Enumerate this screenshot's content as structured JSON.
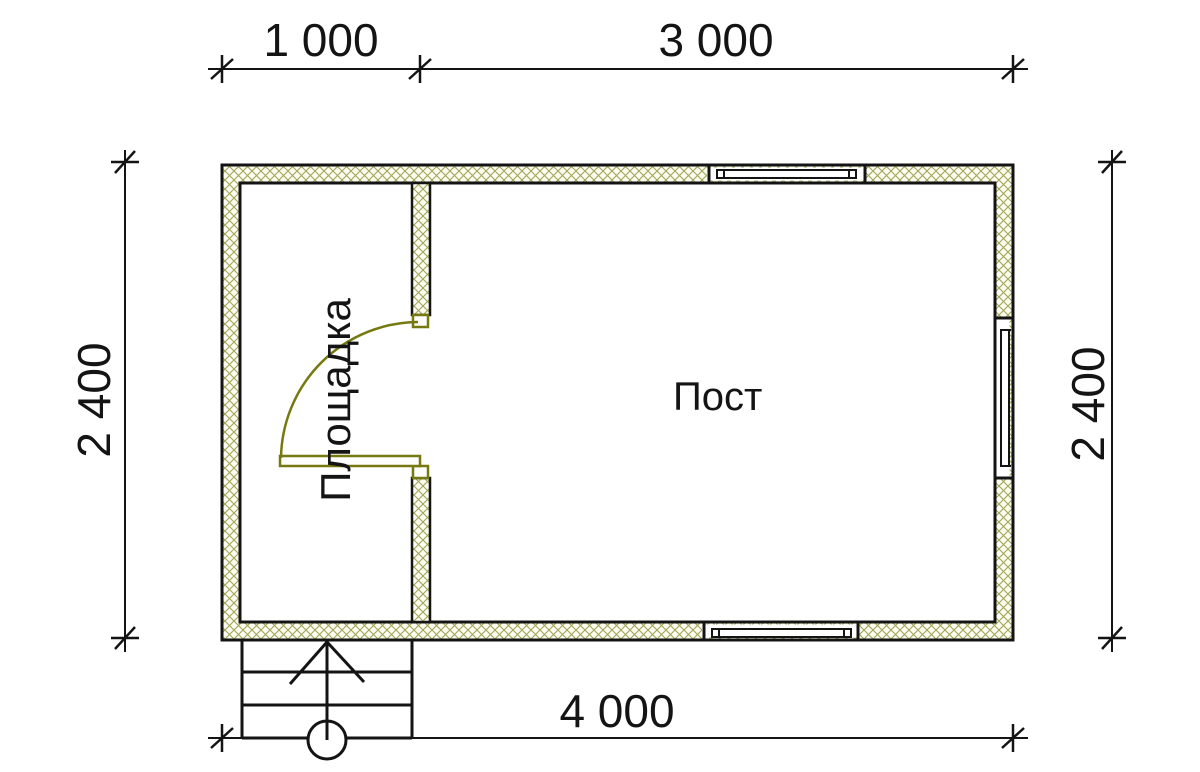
{
  "dimensions": {
    "top_left": "1 000",
    "top_right": "3 000",
    "left": "2 400",
    "right": "2 400",
    "bottom": "4 000"
  },
  "rooms": {
    "left_label": "Площадка",
    "right_label": "Пост"
  },
  "watermark": {
    "text": "VANDA"
  },
  "colors": {
    "ink": "#141414",
    "hatch_line": "#a2a656",
    "hatch_bg": "#fcfcf2",
    "door": "#75790f",
    "logo_pink": "#f7cad0",
    "logo_pink_shade": "#eeb5bd",
    "logo_blue": "#cedceb",
    "logo_blue_top": "#dfeaf5",
    "logo_blue_side": "#b6c7db",
    "logo_text": "#ffffff"
  }
}
